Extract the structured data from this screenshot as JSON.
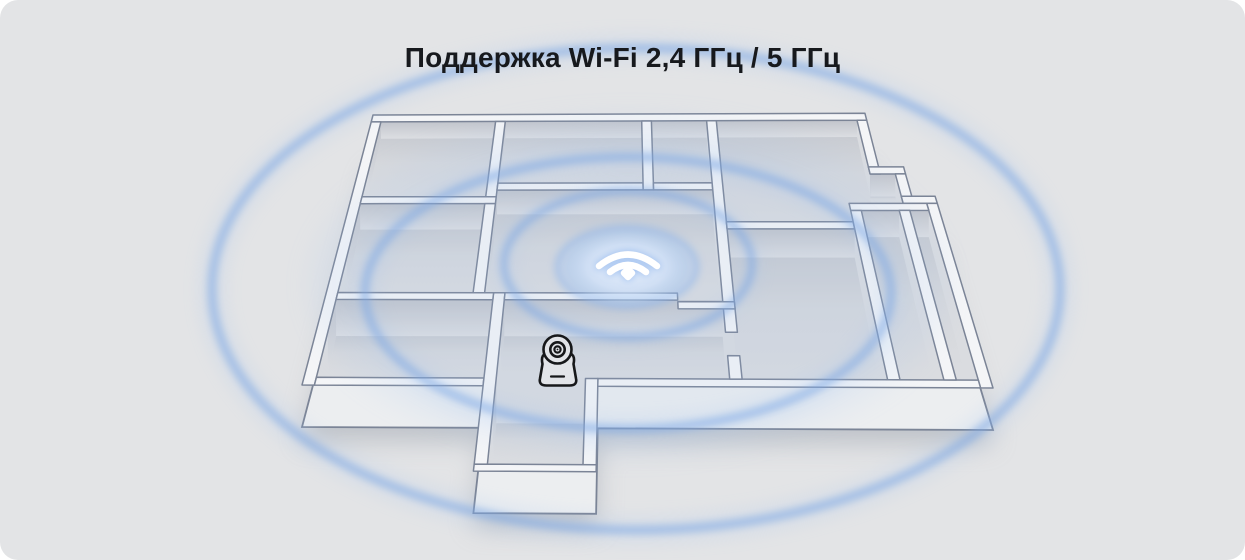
{
  "card": {
    "title": "Поддержка Wi-Fi 2,4 ГГц / 5 ГГц",
    "background_color": "#e3e4e6",
    "title_color": "#17191d"
  },
  "illustration": {
    "type": "isometric-floorplan-wifi-coverage",
    "ring_count": 4,
    "icons": [
      {
        "name": "wifi-icon",
        "color": "#ffffff"
      },
      {
        "name": "camera-icon",
        "color": "#17181a"
      }
    ],
    "colors": {
      "ring_blue": "#7aa6e4",
      "ring_halo": "#9cc0ee",
      "disc_center": "#edf4fe",
      "wall_fill": "#f4f5f7",
      "wall_outline": "#7b8496",
      "floor_dark": "#c9ccd2",
      "floor_fill": "#dadce0",
      "face_dark": "#c2c5cc",
      "face_light": "#dcdee2",
      "slab_fill": "#eceef0",
      "shadow": "#99a0ab"
    }
  }
}
